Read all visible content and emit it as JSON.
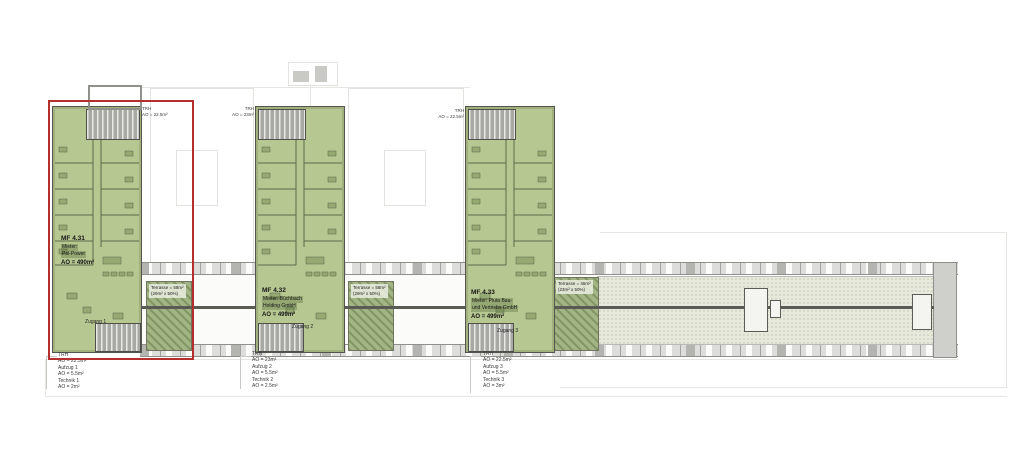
{
  "colors": {
    "highlight_red": "#b5302c",
    "wing_green": "#b7c791",
    "terrace_green": "#a4b585",
    "wall_gray": "#dddddb"
  },
  "wings": [
    {
      "id": "MF 4.31",
      "tenant_l1": "Mieter:",
      "tenant_l2": "Pol-Power",
      "area": "AO = 490m²",
      "trh": [
        "TRH",
        "AO = 22.5m²"
      ],
      "terrace": [
        "Terrasse = 58m²",
        "(29m² x 50%)"
      ],
      "zugang": "Zugang 1",
      "notes": [
        "TRH",
        "AO = 22.5m²",
        "Aufzug 1",
        "AO = 5.5m²",
        "Technik 1",
        "AO = 2m²"
      ]
    },
    {
      "id": "MF 4.32",
      "tenant_l1": "Mieter: Büchbach",
      "tenant_l2": "Holding GmbH",
      "area": "AO = 499m²",
      "trh": [
        "TRH",
        "AO = 23m²"
      ],
      "terrace": [
        "Terrasse = 58m²",
        "(29m² x 50%)"
      ],
      "zugang": "Zugang 2",
      "notes": [
        "TRH",
        "AO = 23m²",
        "Aufzug 2",
        "AO = 5.5m²",
        "Technik 2",
        "AO = 2.5m²"
      ]
    },
    {
      "id": "MF 4.33",
      "tenant_l1": "Mieter: Pluta Bau-",
      "tenant_l2": "und Vertriebs GmbH",
      "area": "AO = 499m²",
      "trh": [
        "TRH",
        "AO = 22.5m²"
      ],
      "terrace": [
        "Terrasse = 46m²",
        "(23m² x 50%)"
      ],
      "zugang": "Zugang 3",
      "notes": [
        "TRH",
        "AO = 22.5m²",
        "Aufzug 3",
        "AO = 5.5m²",
        "Technik 3",
        "AO = 3m²"
      ]
    }
  ]
}
